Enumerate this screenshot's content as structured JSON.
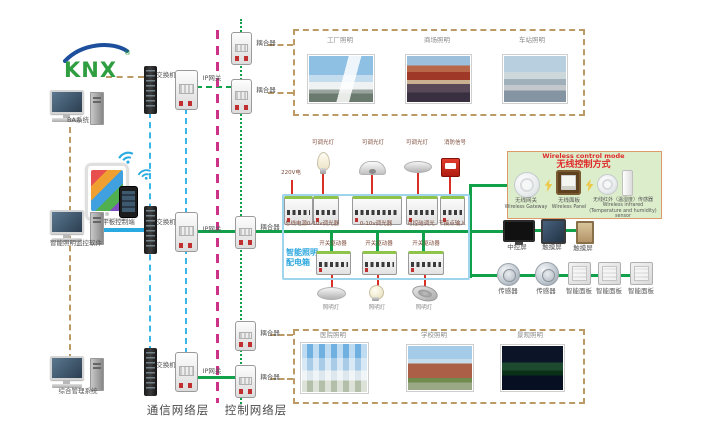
{
  "logo": {
    "text": "KNX",
    "reg": "®"
  },
  "left": {
    "computer1_label": "BA系统",
    "mobile_label": "手机平板控制端",
    "computer2_label": "智能照明监控软件",
    "computer3_label": "综合管理系统"
  },
  "network": {
    "switch_label": "交换机",
    "gateway_label": "IP网关",
    "coupler_label": "耦合器",
    "comm_layer": "通信网络层",
    "ctrl_layer": "控制网络层"
  },
  "scenes": {
    "top": [
      "工厂照明",
      "商场照明",
      "车站照明"
    ],
    "bottom": [
      "医院照明",
      "学校照明",
      "景观照明"
    ]
  },
  "panel": {
    "name_line1": "智能照明",
    "name_line2": "配电箱",
    "input_label": "220V电",
    "dimmable_lamp_label": "可调光灯",
    "fire_signal_label": "消防信号",
    "modules_top": [
      "总线电源",
      "0-10v调光器",
      "0-10v调光器",
      "可控硅调光",
      "干接点输入"
    ],
    "driver_label": "开关驱动器",
    "lamp_label": "照明灯"
  },
  "wireless": {
    "title_en": "Wireless control mode",
    "title_zh": "无线控制方式",
    "items": [
      {
        "zh": "无线网关",
        "en": "Wireless Gateway"
      },
      {
        "zh": "无线面板",
        "en": "Wireless Panel"
      },
      {
        "zh": "无线红外（温湿度）传感器",
        "en": "Wireless infrared (Temperature and humidity) sensor"
      }
    ]
  },
  "right": {
    "screens": [
      "中控屏",
      "触摸屏",
      "触摸屏"
    ],
    "devices": [
      "传感器",
      "传感器",
      "智能面板",
      "智能面板",
      "智能面板"
    ]
  },
  "colors": {
    "bus_green": "#12a14b",
    "line_blue": "#29abe2",
    "layer_magenta": "#cc3388",
    "dash_tan": "#bb9a66",
    "signal_red": "#d93025",
    "panel_border_blue": "#9ed4ec",
    "wireless_bg": "#dcedcb"
  }
}
